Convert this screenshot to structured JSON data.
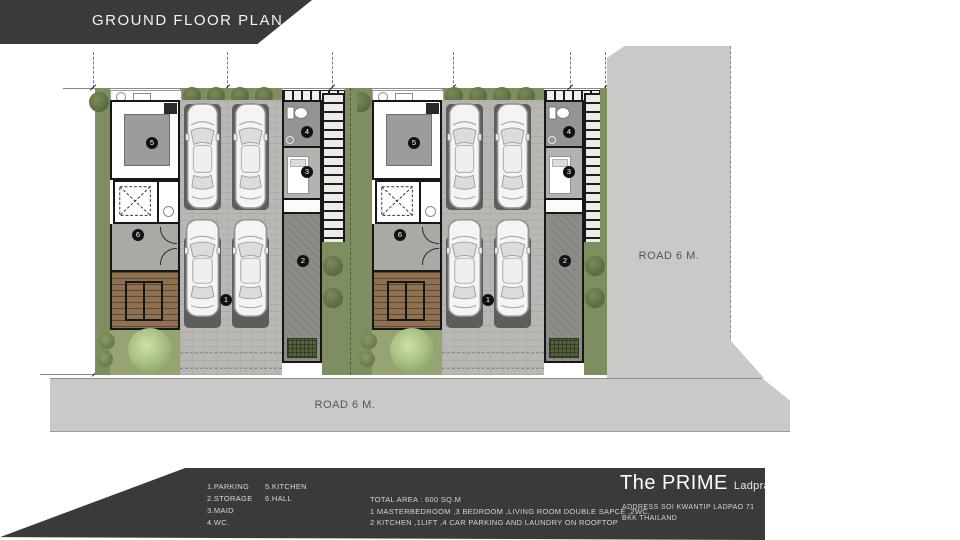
{
  "banner": {
    "title": "GROUND FLOOR PLAN"
  },
  "plan": {
    "room_numbers": {
      "parking": "1",
      "storage": "2",
      "maid": "3",
      "wc": "4",
      "kitchen": "5",
      "hall": "6"
    }
  },
  "roads": {
    "right_label": "ROAD 6 M.",
    "bottom_label": "ROAD 6 M."
  },
  "legend": {
    "items": [
      "1.PARKING",
      "2.STORAGE",
      "3.MAID",
      "4.WC.",
      "5.KITCHEN",
      "6.HALL"
    ]
  },
  "summary": {
    "lines": [
      "TOTAL AREA : 600 SQ.M",
      "1 MASTERBEDROOM ,3 BEDROOM ,LIVING ROOM DOUBLE SAPCE ,2WC.",
      "2 KITCHEN ,1LIFT ,4 CAR PARKING AND LAUNDRY ON ROOFTOP"
    ]
  },
  "brand": {
    "name": "The PRIME",
    "project": "Ladprao 71",
    "address1": "ADDRESS SOI KWANTIP  LADPAO 71",
    "address2": "BKK THAILAND"
  },
  "colors": {
    "panel_dark": "#3a3a3a",
    "road_gray": "#c9c9c8",
    "grass_olive": "#7f8e60",
    "grass_light": "#96a474",
    "paver_gray": "#b8b7b3",
    "parking_spot": "#5d5d5b",
    "stair_wood": "#8d7152",
    "wall_black": "#161616"
  },
  "icons": {
    "car": "top-view car (inline svg)",
    "toilet": "toilet tank+bowl (inline svg)",
    "lift": "dashed X shaft (inline svg)",
    "tree": "canopy circle (css radial)",
    "sink": "circle outline (css)",
    "stove": "rect outline (css)"
  }
}
